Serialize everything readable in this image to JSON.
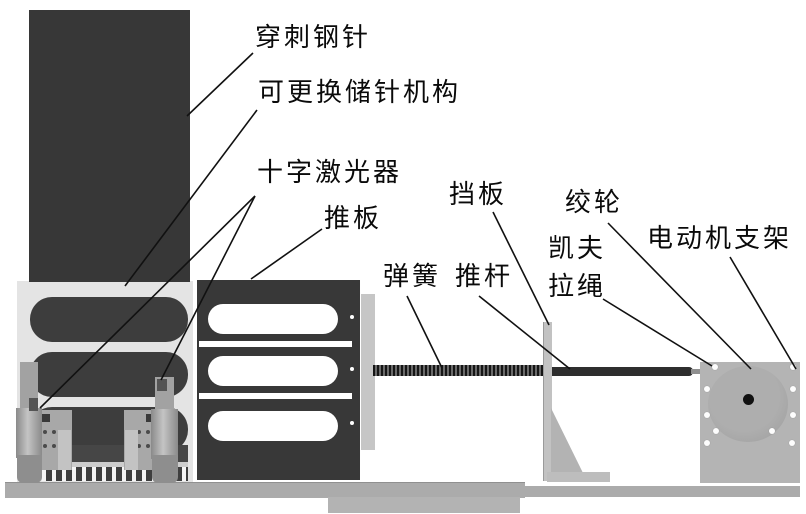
{
  "labels": {
    "needle": "穿刺钢针",
    "magazine": "可更换储针机构",
    "laser": "十字激光器",
    "push_plate": "推板",
    "baffle": "挡板",
    "spring": "弹簧",
    "push_rod": "推杆",
    "winch": "绞轮",
    "kevlar_line1": "凯夫",
    "kevlar_line2": "拉绳",
    "motor_bracket": "电动机支架"
  },
  "colors": {
    "dark_component": "#383838",
    "light_block": "#e4e4e4",
    "metal_gray": "#b4b4b4",
    "base_gray": "#ababab",
    "leader_line": "#111111",
    "background": "#ffffff"
  }
}
